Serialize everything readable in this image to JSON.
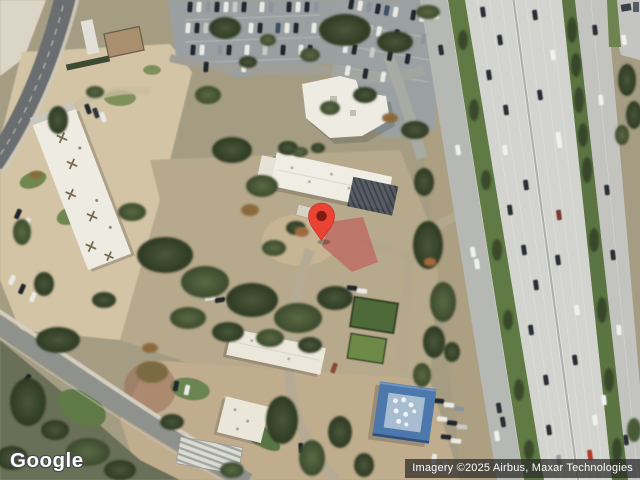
{
  "map": {
    "view_type": "satellite",
    "logo_text": "Google",
    "attribution": "Imagery ©2025 Airbus, Maxar Technologies",
    "marker": {
      "color": "#EA4335",
      "outline_color": "#C5221F",
      "dot_color": "#7E1B10"
    },
    "palette": {
      "tree_dark": "#37462a",
      "tree_mid": "#4c5c3c",
      "grass_median": "#5f7a44",
      "lawn": "#6f8850",
      "dirt": "#b7a98c",
      "plaza_beige": "#d5c6a7",
      "road_asphalt": "#6b6e70",
      "road_local": "#8f918d",
      "highway_concrete": "#d3d4cf",
      "frontage_road": "#b6b8b3",
      "roof_white": "#efece3",
      "roof_blue": "#4c78ab",
      "courtyard_red": "#bc7066",
      "parking_gray": "#9aa0a2"
    }
  }
}
